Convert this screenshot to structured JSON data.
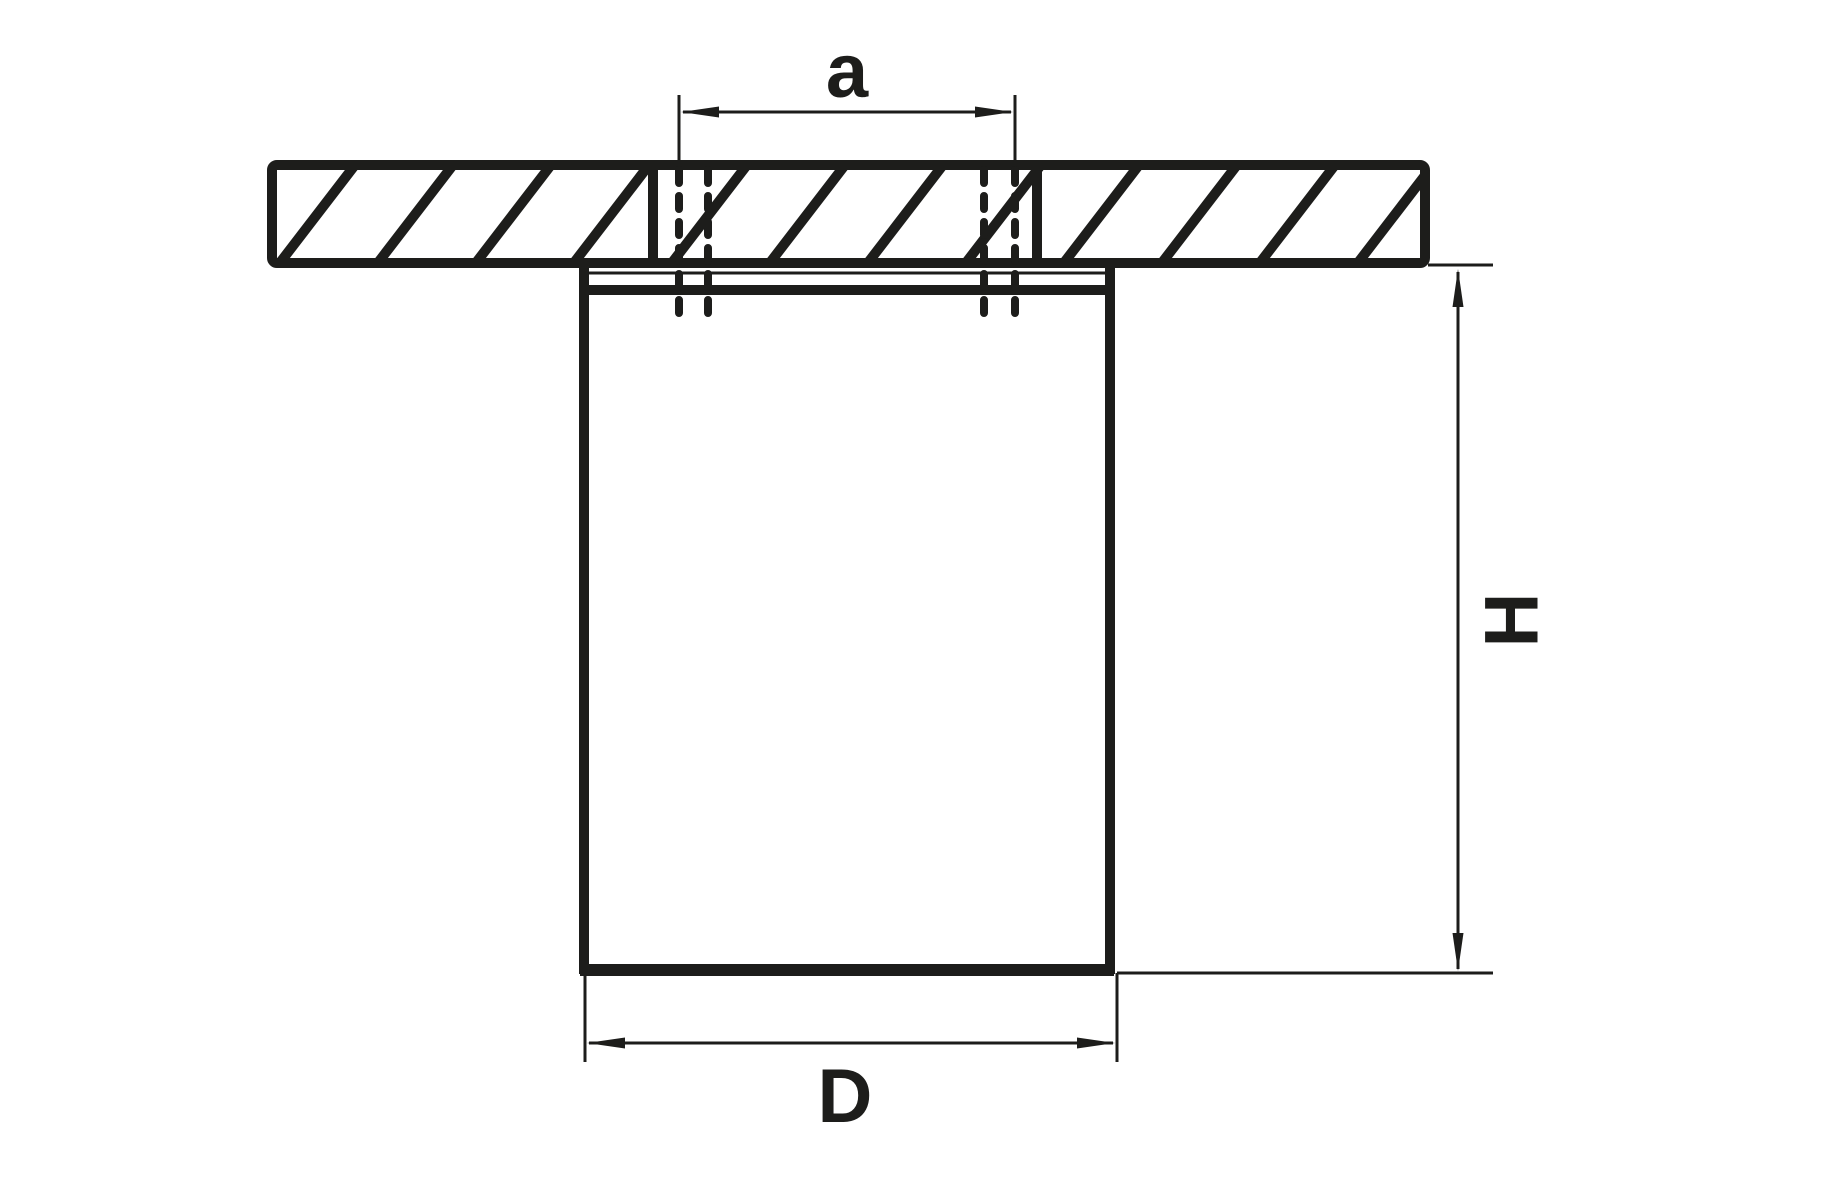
{
  "diagram": {
    "labels": {
      "screw_spacing": "a",
      "height": "H",
      "diameter": "D"
    },
    "colors": {
      "line": "#1d1d1b",
      "background": "#ffffff"
    }
  }
}
